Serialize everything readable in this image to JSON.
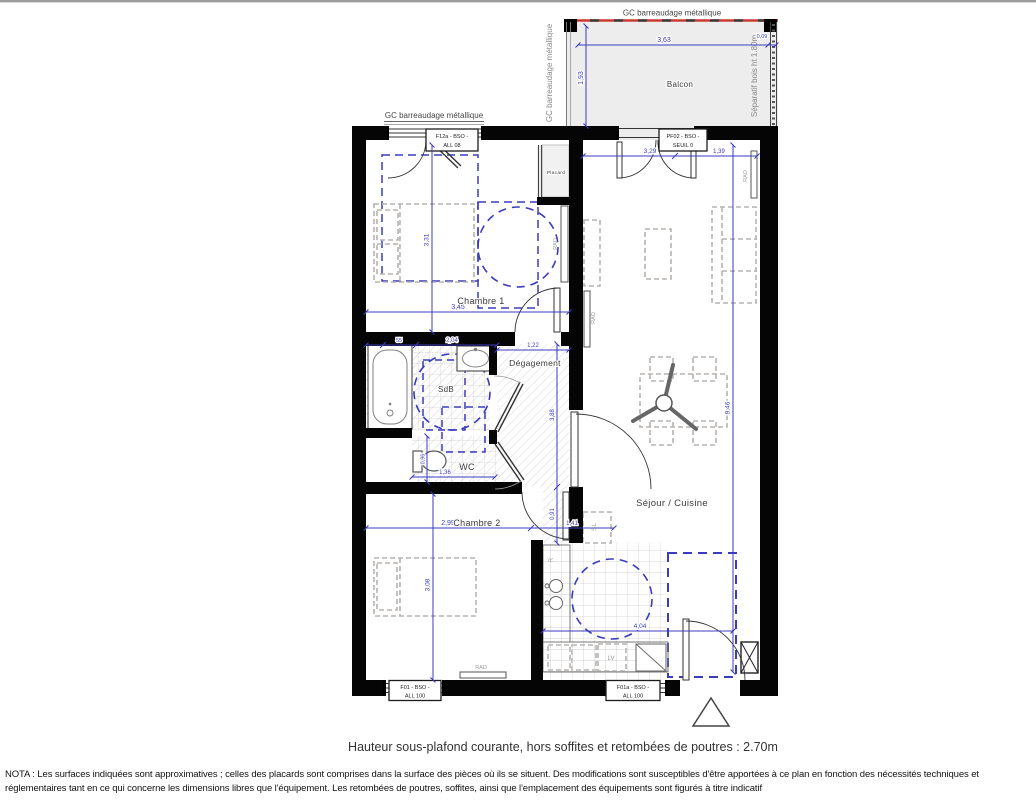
{
  "rooms": {
    "chambre1": "Chambre 1",
    "chambre2": "Chambre 2",
    "sdb": "SdB",
    "wc": "WC",
    "degagement": "Dégagement",
    "sejour": "Séjour / Cuisine",
    "placard": "Placard",
    "balcon": "Balcon"
  },
  "labels": {
    "gc_balcony_top": "GC barreaudage métallique",
    "gc_balcony_side": "GC barreaudage métallique",
    "gc_window": "GC barreaudage métallique",
    "separatif": "Séparatif bois ht 1.80m"
  },
  "windows": {
    "f12a_line1": "F12a - BSO -",
    "f12a_line2": "ALL 08",
    "pf02_line1": "PF02 - BSO -",
    "pf02_line2": "SEUIL 0",
    "f01_line1": "F01 - BSO -",
    "f01_line2": "ALL 100",
    "f01a_line1": "F01a - BSO -",
    "f01a_line2": "ALL 100"
  },
  "equipment": {
    "rad": "RAD",
    "sl": "SL",
    "lv": "LV",
    "r": "R"
  },
  "dims": {
    "balcony_w": "3,63",
    "balcony_d": "1,93",
    "balcony_gap": "0,09",
    "sejour_w": "3,29",
    "sejour_door": "1,39",
    "sejour_h": "9,46",
    "c1_w": "3,45",
    "c1_h": "3,31",
    "sdb_a": "55",
    "sdb_b": "2,04",
    "deg_w": "1,22",
    "deg_h": "3,88",
    "hall_h": "0,91",
    "wc_w": "1,36",
    "wc_h": "0,96",
    "c2_w": "2,99",
    "c2_ext": "1,41",
    "c2_h": "3,08",
    "kitchen_w": "4,04"
  },
  "footer": {
    "caption": "Hauteur sous-plafond courante, hors soffites et retombées de poutres : 2.70m",
    "nota1": "NOTA : Les surfaces indiquées sont approximatives ; celles des placards sont comprises dans la surface des pièces où ils se situent. Des modifications sont susceptibles d'être apportées à ce plan en fonction des nécessités techniques et",
    "nota2": "réglementaires tant en ce qui concerne les dimensions libres que l'équipement. Les retombées de poutres, soffites, ainsi que l'emplacement des équipements sont figurés à titre indicatif"
  },
  "colors": {
    "dimension_blue": "#3b3bbf",
    "wall_black": "#000000",
    "railing_red": "#c9392e",
    "furniture_gray": "#b5b2ae",
    "balcony_fill": "#ededed"
  }
}
